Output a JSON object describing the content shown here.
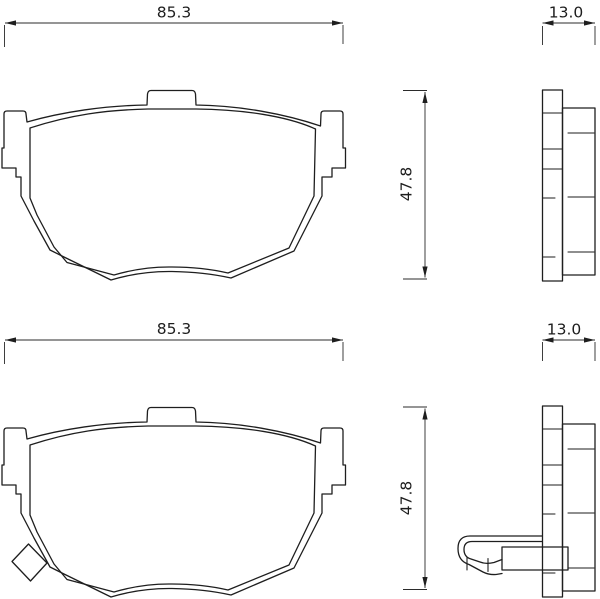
{
  "canvas": {
    "background": "#ffffff",
    "line_color": "#1e1e1e"
  },
  "drawings": [
    {
      "width": "85.3",
      "thickness": "13.0",
      "height": "47.8"
    },
    {
      "width": "85.3",
      "thickness": "13.0",
      "height": "47.8"
    }
  ]
}
